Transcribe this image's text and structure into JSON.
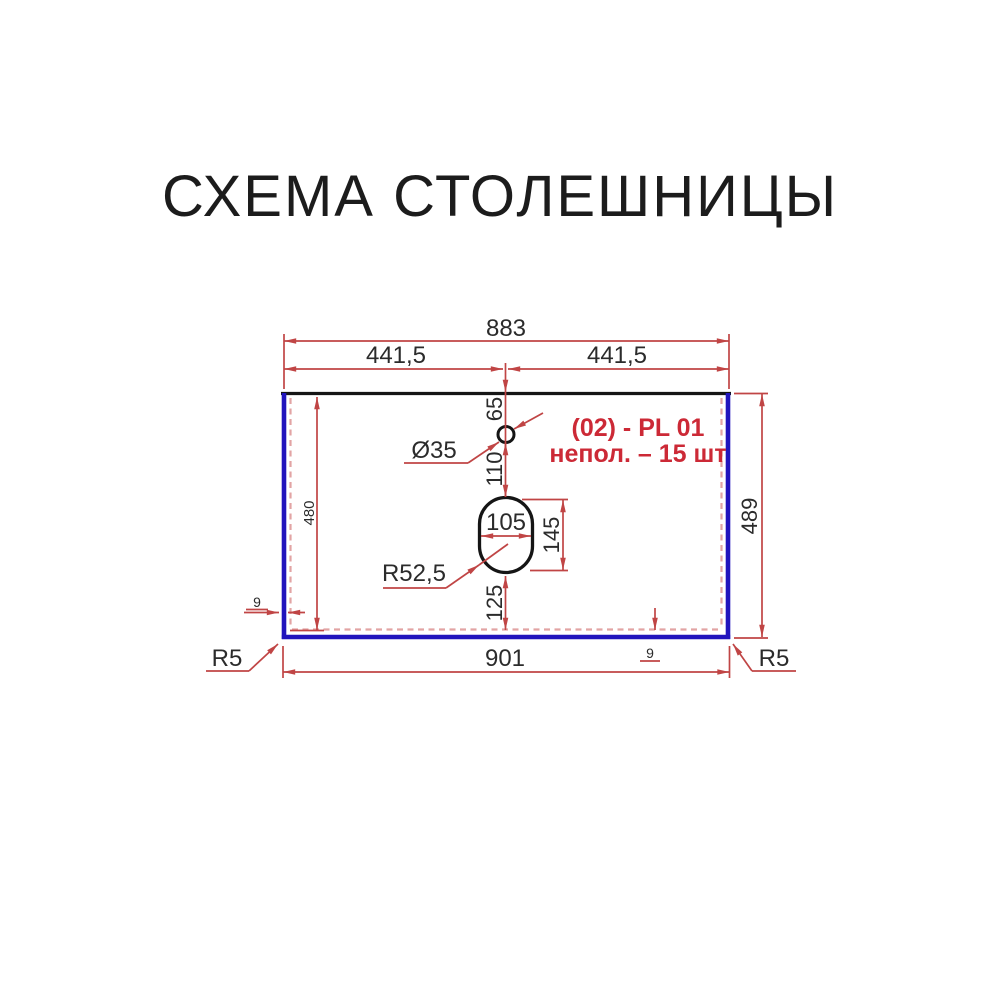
{
  "title": "СХЕМА СТОЛЕШНИЦЫ",
  "colors": {
    "dimension_red": "#c04545",
    "edge_blue": "#2114bd",
    "outline_black": "#151515",
    "dashed_pink": "#e2a4a4",
    "annotation_red": "#cc2936",
    "text_dark": "#2b2b2b",
    "background": "#ffffff"
  },
  "annotation": {
    "line1": "(02) - PL 01",
    "line2": "непол. – 15 шт"
  },
  "dimensions": {
    "top_total": "883",
    "top_left_half": "441,5",
    "top_right_half": "441,5",
    "hole_offset_top": "65",
    "hole_diameter": "Ø35",
    "hole_to_cutout": "110",
    "cutout_width": "105",
    "cutout_height": "145",
    "cutout_radius": "R52,5",
    "cutout_offset_bottom": "125",
    "inner_height": "480",
    "side_height": "489",
    "bottom_total": "901",
    "corner_radius_left": "R5",
    "corner_radius_right": "R5",
    "edge_thickness_left": "9",
    "edge_thickness_bottom": "9"
  }
}
